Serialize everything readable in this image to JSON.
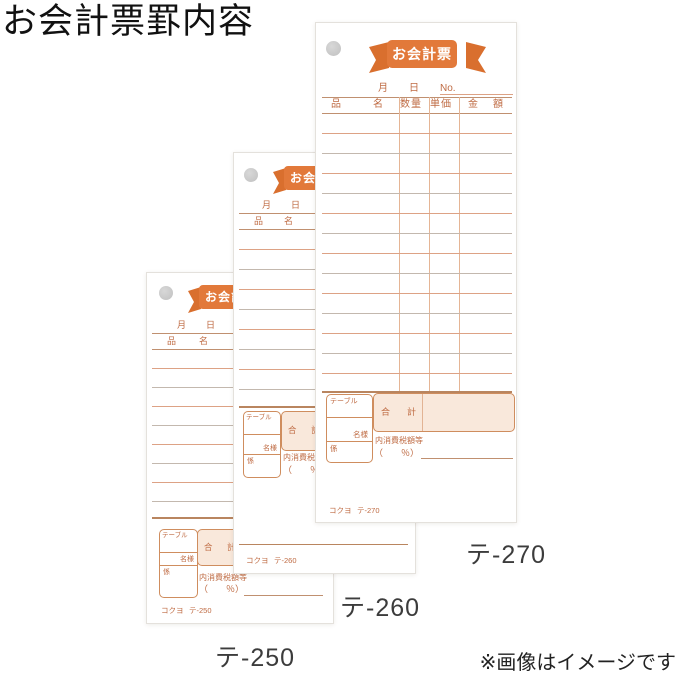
{
  "page": {
    "title": "お会計票罫内容",
    "note": "※画像はイメージです"
  },
  "slip": {
    "ribbon_title": "お会計票",
    "month": "月",
    "day": "日",
    "no": "No.",
    "col_item_a": "品",
    "col_item_b": "名",
    "col_qty": "数量",
    "col_unit_price": "単価",
    "col_amount_a": "金",
    "col_amount_b": "額",
    "table_label": "テーブル",
    "guests_label": "名様",
    "staff_label": "係",
    "total_a": "合",
    "total_b": "計",
    "tax_label": "内消費税額等",
    "tax_percent": "（　　％）",
    "brand": "コクヨ"
  },
  "slips": [
    {
      "code": "テ-250",
      "caption": "テ-250"
    },
    {
      "code": "テ-260",
      "caption": "テ-260"
    },
    {
      "code": "テ-270",
      "caption": "テ-270"
    }
  ],
  "colors": {
    "ribbon_orange": "#e2793a",
    "ribbon_tail": "#d96f2e",
    "slip_text": "#bf6b43",
    "line_orange": "#dda285",
    "line_gray": "#c3b8ae",
    "line_dark": "#b9855f",
    "column_line": "#e5b595",
    "total_fill": "#f9e8db",
    "box_border": "#cf8d5e",
    "hole_gray": "#c7c7c7"
  }
}
